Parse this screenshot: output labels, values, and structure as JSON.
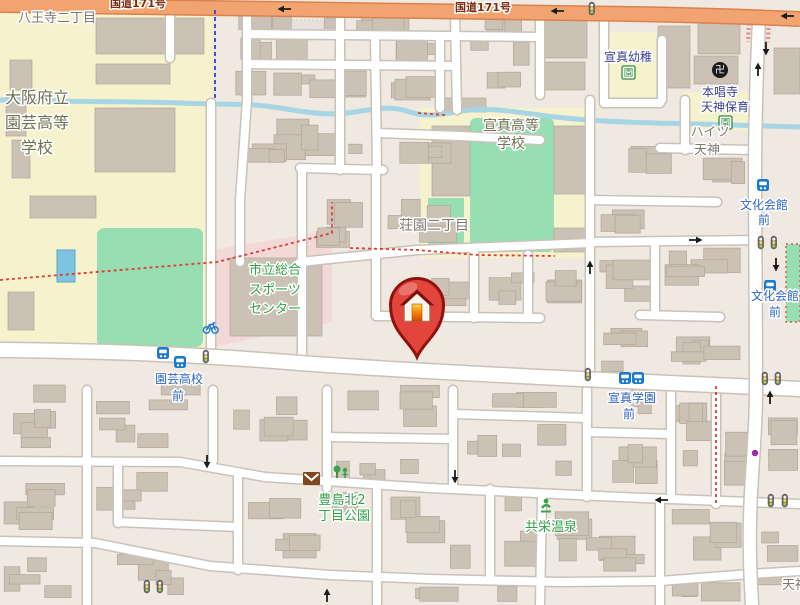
{
  "map": {
    "route_label": "国道171号",
    "labels": {
      "hachioji": "八王寺二丁目",
      "engei_school_l1": "大阪府立",
      "engei_school_l2": "園芸高等",
      "engei_school_l3": "学校",
      "senshin_hs_l1": "宣真高等",
      "senshin_hs_l2": "学校",
      "shoen": "荘園二丁目",
      "sports_l1": "市立総合",
      "sports_l2": "スポーツ",
      "sports_l3": "センター",
      "senshin_kg": "宣真幼稚",
      "honshoji": "本唱寺",
      "tenjin_hoiku": "天神保育",
      "heights_l1": "ハイツ",
      "heights_l2": "天神",
      "bunka_l1": "文化会館",
      "bunka_l2": "前",
      "engei_bus_l1": "園芸高校",
      "engei_bus_l2": "前",
      "senshin_bus_l1": "宣真学園",
      "senshin_bus_l2": "前",
      "toyoshima_l1": "豊島北2",
      "toyoshima_l2": "丁目公園",
      "kyoei_onsen": "共栄温泉",
      "tenjin_partial": "天神"
    },
    "glyphs": {
      "temple": "卍",
      "garden_box": "園"
    },
    "icons": {
      "marker": "house-pin-icon",
      "bus": "bus-stop-icon",
      "signal": "traffic-signal-icon",
      "temple": "temple-icon",
      "kindergarten": "kindergarten-icon",
      "post": "post-office-icon",
      "park": "playground-icon",
      "onsen": "onsen-icon",
      "bicycle": "bicycle-parking-icon"
    },
    "colors": {
      "highway": "#F2A470",
      "school_area": "#F7F2CE",
      "field_green": "#97DEB2",
      "sports_pink": "#F3D8D8",
      "stream": "#A6D5E4",
      "bus_blue": "#1C79CE",
      "bus_text": "#2E64C8",
      "marker_red": "#E2453C",
      "boundary_red": "#E23B2E",
      "boundary_blue": "#4C4CD8"
    }
  }
}
